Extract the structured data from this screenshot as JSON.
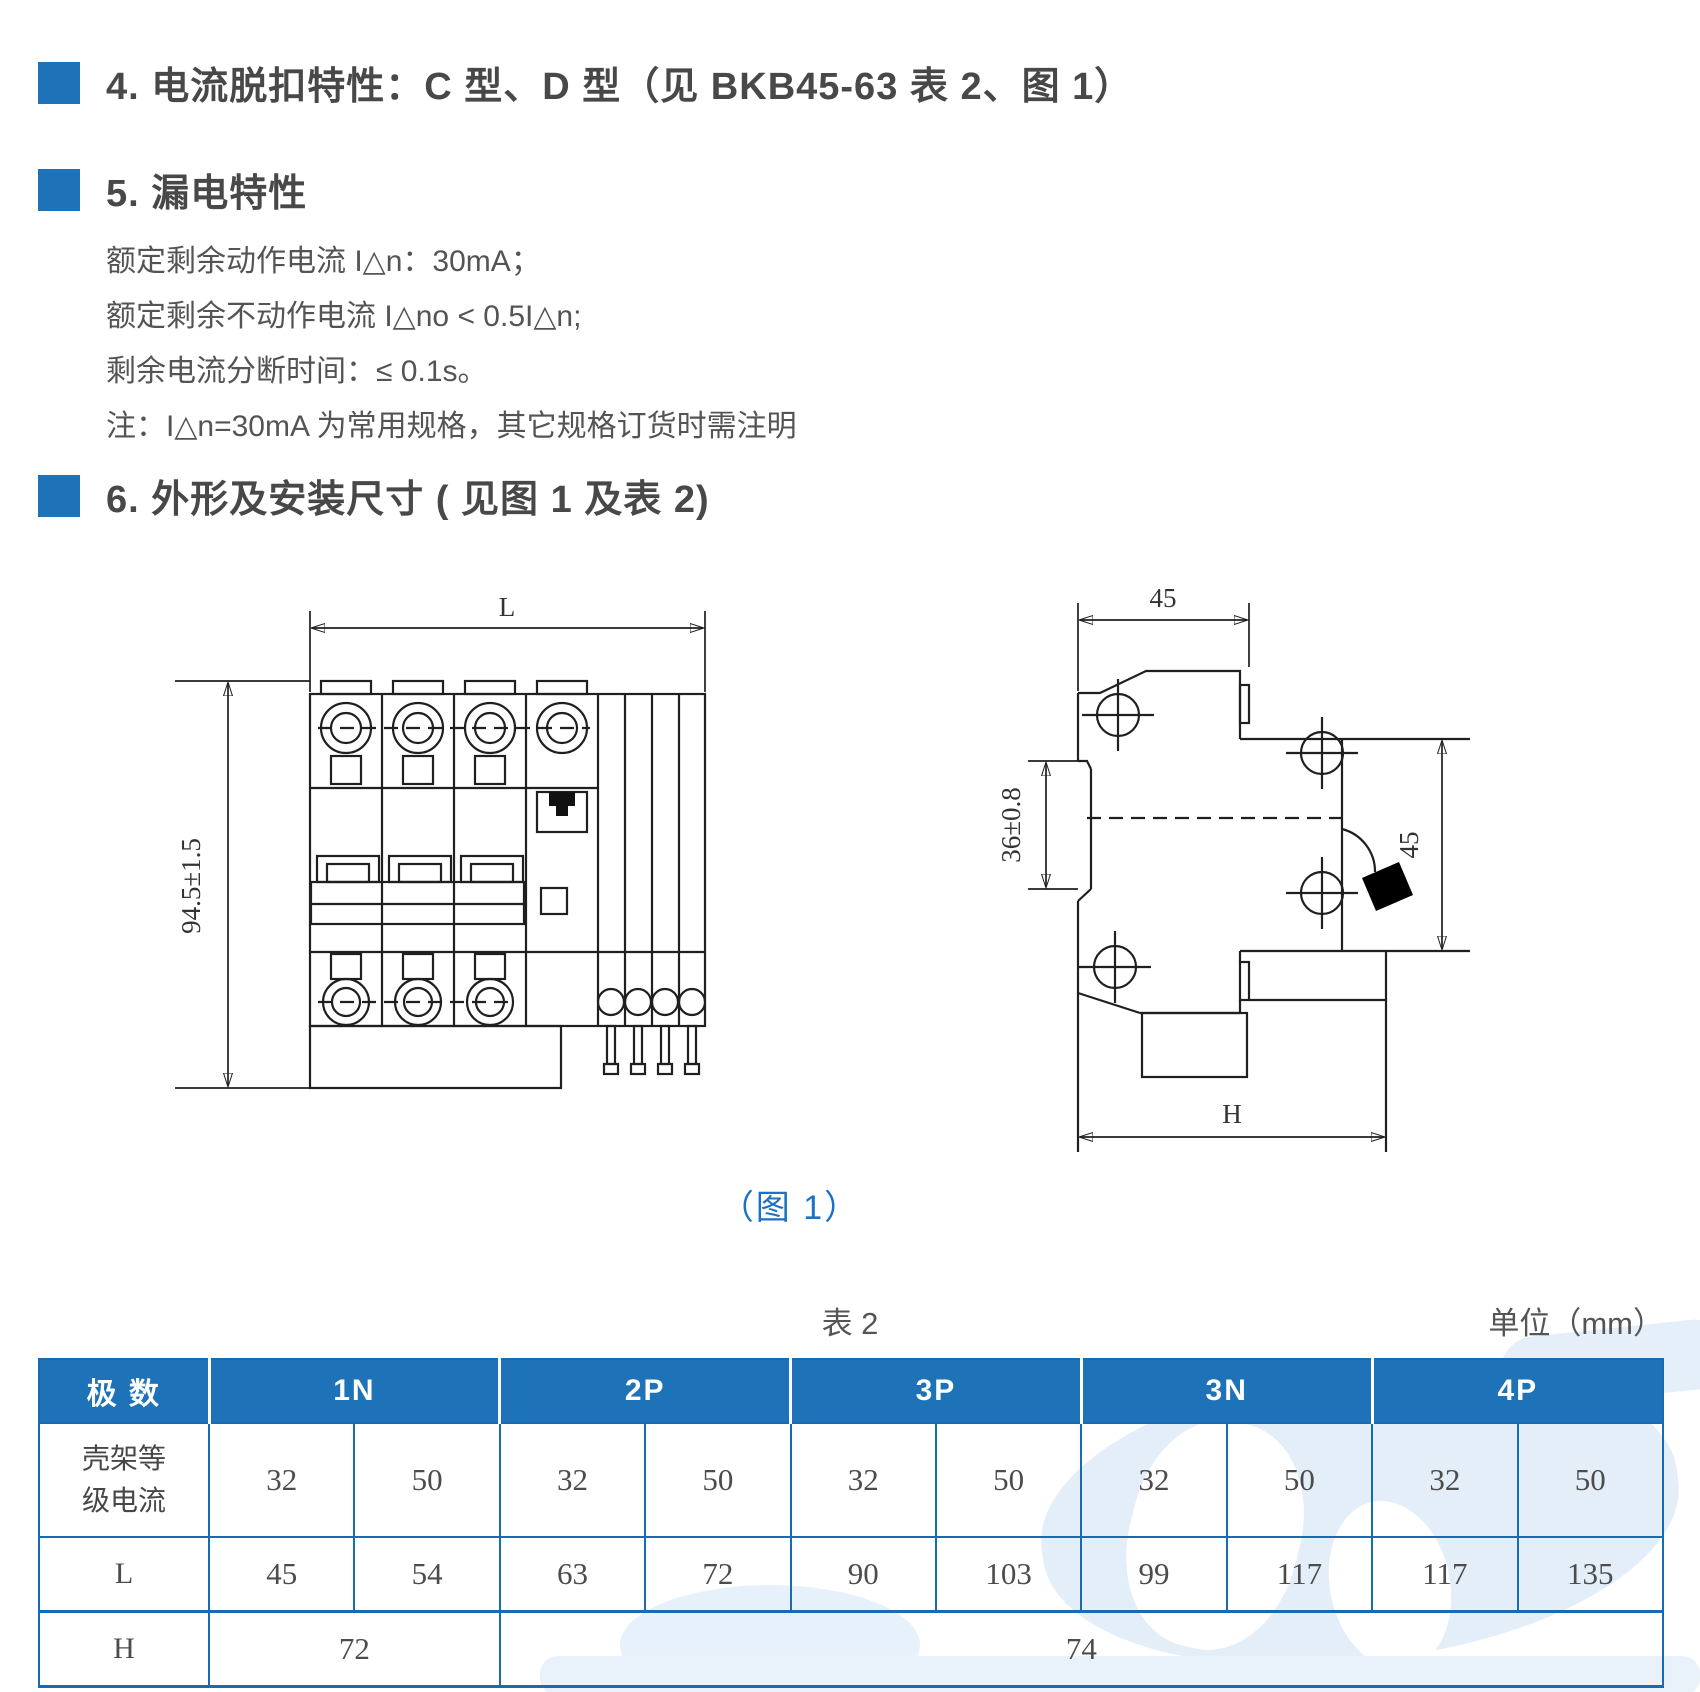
{
  "colors": {
    "accent": "#1e73b8",
    "table_border": "#176bb4",
    "caption_blue": "#1b72c2"
  },
  "sections": {
    "s4": {
      "title": "4. 电流脱扣特性：C 型、D 型（见 BKB45-63 表 2、图 1）"
    },
    "s5": {
      "title": "5. 漏电特性",
      "lines": [
        "额定剩余动作电流 I△n：30mA；",
        "额定剩余不动作电流 I△no < 0.5I△n;",
        "剩余电流分断时间：≤ 0.1s。",
        "注：I△n=30mA 为常用规格，其它规格订货时需注明"
      ]
    },
    "s6": {
      "title": "6. 外形及安装尺寸 ( 见图 1 及表 2)"
    }
  },
  "figure": {
    "caption": "（图 1）",
    "front_view": {
      "dim_width": "L",
      "dim_height": "94.5±1.5"
    },
    "side_view": {
      "dim_top": "45",
      "dim_left": "36±0.8",
      "dim_right": "45",
      "dim_bottom": "H"
    }
  },
  "table": {
    "title": "表 2",
    "unit": "单位（mm）",
    "corner": "极 数",
    "groups": [
      "1N",
      "2P",
      "3P",
      "3N",
      "4P"
    ],
    "rows": [
      {
        "label": "壳架等级电流",
        "values": [
          "32",
          "50",
          "32",
          "50",
          "32",
          "50",
          "32",
          "50",
          "32",
          "50"
        ]
      },
      {
        "label": "L",
        "values": [
          "45",
          "54",
          "63",
          "72",
          "90",
          "103",
          "99",
          "117",
          "117",
          "135"
        ]
      },
      {
        "label": "H",
        "values": [
          "72",
          "74"
        ]
      }
    ]
  }
}
